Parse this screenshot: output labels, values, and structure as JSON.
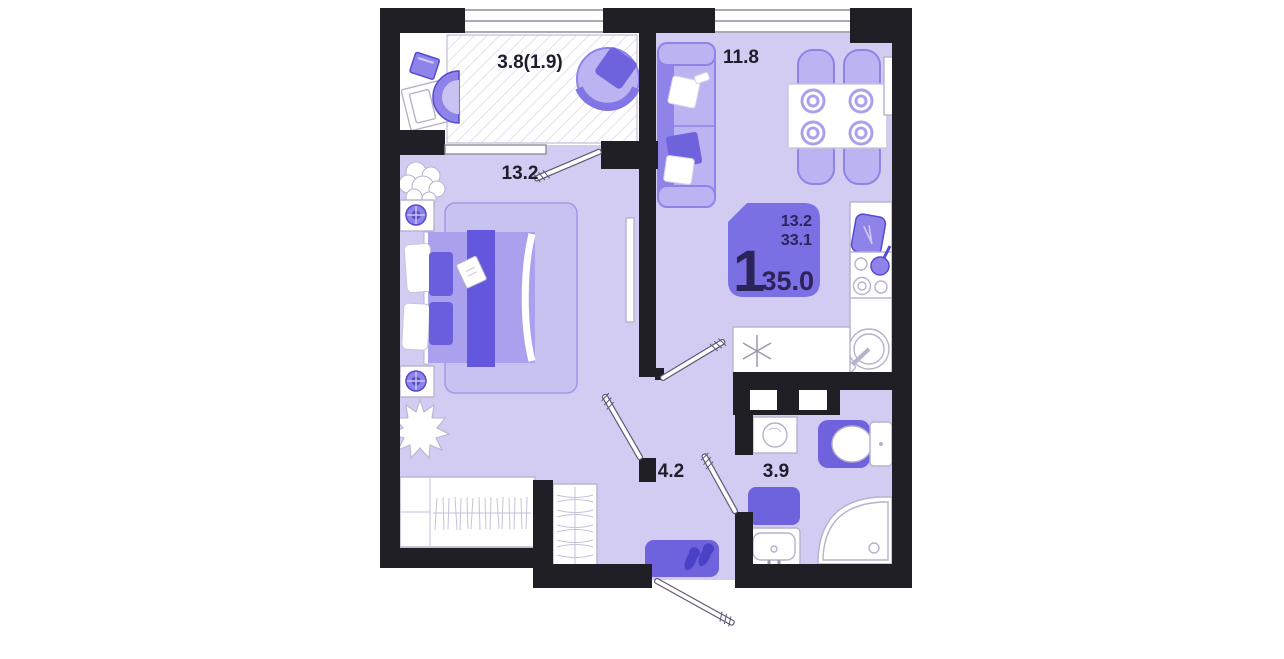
{
  "plan": {
    "rooms": {
      "balcony": {
        "area_label": "3.8(1.9)"
      },
      "bedroom": {
        "area_label": "13.2"
      },
      "kitchen_living": {
        "area_label": "11.8"
      },
      "hallway": {
        "area_label": "4.2"
      },
      "bathroom": {
        "area_label": "3.9"
      }
    },
    "badge": {
      "rooms_count": "1",
      "living_area": "13.2",
      "area_without_balcony": "33.1",
      "total_area": "35.0"
    },
    "colors": {
      "wall": "#211f26",
      "floor": "#d2ccf3",
      "outline": "#b6b2cc",
      "furniture_light": "#bcb4f2",
      "furniture_mid": "#8d83e9",
      "furniture_strong": "#6e63dd",
      "furniture_dark": "#554ad0",
      "badge_background": "#7b70e3",
      "badge_text": "#2a2458",
      "label_text": "#1f1d2b",
      "window_line": "#8f8ca0",
      "hatch_line": "#e2dff1"
    }
  }
}
